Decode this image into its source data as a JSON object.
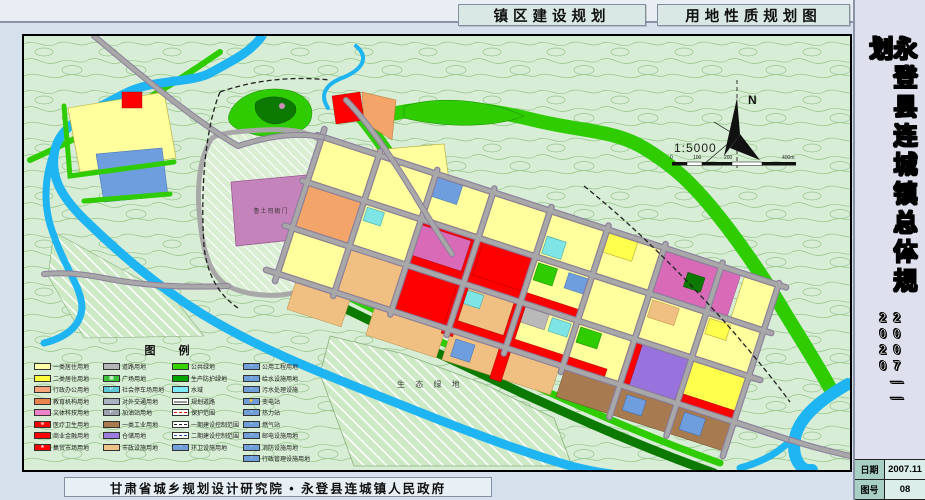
{
  "header": {
    "band_title_left": "镇区建设规划",
    "band_title_right": "用地性质规划图"
  },
  "sidebar": {
    "title": "永登县连城镇总体规划",
    "period": "2007——2020",
    "info": [
      {
        "label": "日期",
        "value": "2007.11"
      },
      {
        "label": "图号",
        "value": "08"
      }
    ]
  },
  "footer": {
    "organization": "甘肃省城乡规划设计研究院 • 永登县连城镇人民政府"
  },
  "map": {
    "labels": {
      "historic_site": "鲁土司衙门",
      "eco_green": "生 态 绿 地"
    },
    "north": "N",
    "scale": "1:5000",
    "scale_ticks": [
      "0",
      "100",
      "200",
      "400m"
    ]
  },
  "legend": {
    "title": "图  例",
    "columns": [
      {
        "items": [
          {
            "label": "一类居住用地",
            "color": "#ffffa8"
          },
          {
            "label": "二类居住用地",
            "color": "#ffff3c"
          },
          {
            "label": "行政办公用地",
            "color": "#f6a57a"
          },
          {
            "label": "教育机构用地",
            "color": "#e8854e"
          },
          {
            "label": "文体科技用地",
            "color": "#ec82c8"
          },
          {
            "label": "医疗卫生用地",
            "color": "#fe0000",
            "glyph": "⊕"
          },
          {
            "label": "商业金融用地",
            "color": "#fe0000"
          },
          {
            "label": "集贸市场用地",
            "color": "#fe0000",
            "glyph": "★"
          }
        ]
      },
      {
        "items": [
          {
            "label": "道路用地",
            "color": "#b5b5b5"
          },
          {
            "label": "广场用地",
            "color": "#3bc43b",
            "glyph": "▦"
          },
          {
            "label": "社会停车场用地",
            "color": "#5cc8d8",
            "glyph": "P"
          },
          {
            "label": "对外交通用地",
            "color": "#a9b2c0"
          },
          {
            "label": "加油站用地",
            "color": "#9aa3ae",
            "glyph": "P"
          },
          {
            "label": "一类工业用地",
            "color": "#a87a4f"
          },
          {
            "label": "仓储用地",
            "color": "#9d7ce0"
          },
          {
            "label": "市政设施用地",
            "color": "#eec387"
          }
        ]
      },
      {
        "items": [
          {
            "label": "公共绿地",
            "color": "#35d400"
          },
          {
            "label": "生产防护绿地",
            "color": "#00a400"
          },
          {
            "label": "水域",
            "color": "#7fe9ff"
          },
          {
            "label": "规划道路",
            "style": "road"
          },
          {
            "label": "保护范围",
            "style": "dashred"
          },
          {
            "label": "一期建设控制范围",
            "style": "dashdot"
          },
          {
            "label": "二期建设控制范围",
            "style": "dashblue"
          },
          {
            "label": "环卫设施用地",
            "color": "#6f9ed9",
            "glyph": "▫"
          }
        ]
      },
      {
        "items": [
          {
            "label": "公用工程用地",
            "color": "#6f9ed9",
            "glyph": "▫"
          },
          {
            "label": "给水设施用地",
            "color": "#6f9ed9",
            "glyph": "▫"
          },
          {
            "label": "污水处理设施",
            "color": "#6f9ed9",
            "glyph": "▫"
          },
          {
            "label": "变电站",
            "color": "#6f9ed9",
            "glyph": "⚡"
          },
          {
            "label": "热力站",
            "color": "#6f9ed9",
            "glyph": "▫"
          },
          {
            "label": "燃气站",
            "color": "#6f9ed9",
            "glyph": "▫"
          },
          {
            "label": "邮电设施用地",
            "color": "#6f9ed9",
            "glyph": "▫"
          },
          {
            "label": "消防设施用地",
            "color": "#6f9ed9",
            "glyph": "▫"
          },
          {
            "label": "行政管理设施用地",
            "color": "#6f9ed9",
            "glyph": "▫"
          }
        ]
      }
    ]
  },
  "palette": {
    "yellow": "#ffff9e",
    "yellow2": "#ffff4d",
    "red": "#fe0000",
    "magenta": "#d96ab8",
    "orange": "#f3a468",
    "tan": "#f0c083",
    "brown": "#a87a4f",
    "purple": "#9973dd",
    "blue": "#6f9ede",
    "cyan": "#7fe4e4",
    "green_bright": "#2ecc00",
    "green_dark": "#0c7a00",
    "water": "#1fb4f2",
    "road": "#a8a8a8",
    "road_casing": "#8d7f9d",
    "map_bg": "#d8edd5",
    "contour": "#74b364"
  }
}
